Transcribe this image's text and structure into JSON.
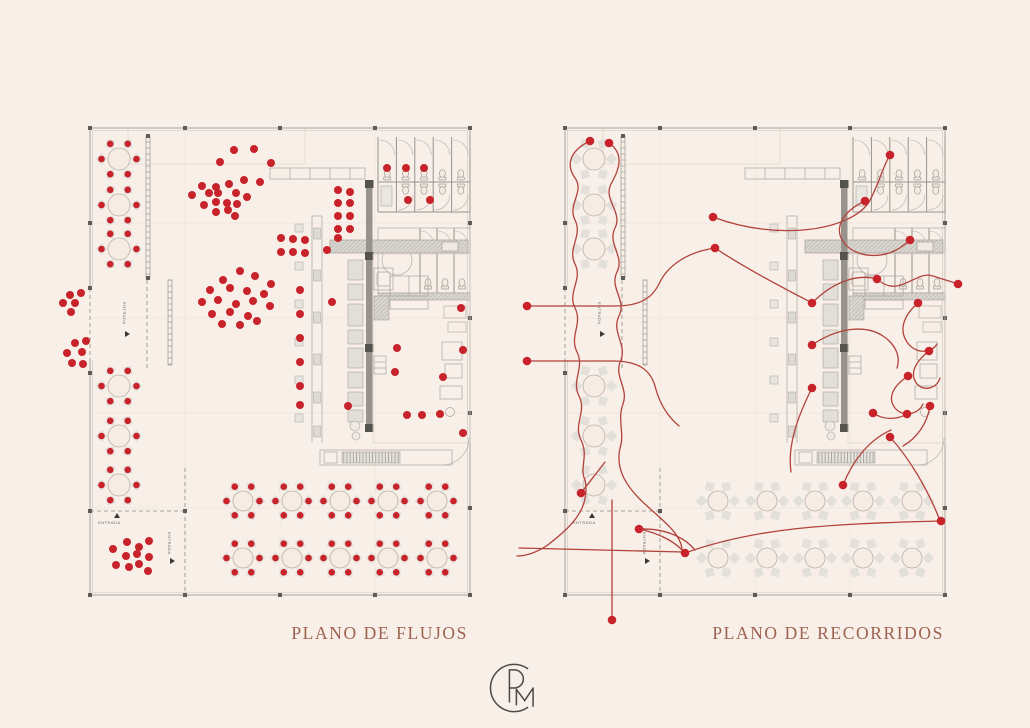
{
  "titles": {
    "left": "PLANO DE FLUJOS",
    "right": "PLANO DE RECORRIDOS"
  },
  "labels": {
    "entrance": "ENTRADA"
  },
  "logo": {
    "monogram": "CRM"
  },
  "colors": {
    "background": "#f8efe8",
    "dot": "#c8232a",
    "route": "#b2423c",
    "title": "#9e6250",
    "line": "#b7b1aa",
    "wall": "#97938c",
    "column": "#5f5c57",
    "furniture": "#e3e0db"
  },
  "furniture": {
    "small_tables": [
      [
        29,
        31
      ],
      [
        29,
        77
      ],
      [
        29,
        121
      ],
      [
        29,
        258
      ],
      [
        29,
        308
      ],
      [
        29,
        357
      ]
    ],
    "big_table_xs": [
      153,
      202,
      250,
      298,
      347
    ],
    "big_table_ys": [
      373,
      430
    ]
  },
  "plans": [
    {
      "id": "flujos",
      "title": "PLANO DE FLUJOS",
      "dots": [
        [
          144,
          22
        ],
        [
          164,
          21
        ],
        [
          130,
          34
        ],
        [
          181,
          35
        ],
        [
          112,
          58
        ],
        [
          126,
          59
        ],
        [
          139,
          56
        ],
        [
          154,
          52
        ],
        [
          170,
          54
        ],
        [
          102,
          67
        ],
        [
          119,
          65
        ],
        [
          128,
          65
        ],
        [
          146,
          65
        ],
        [
          157,
          69
        ],
        [
          114,
          77
        ],
        [
          126,
          74
        ],
        [
          137,
          75
        ],
        [
          147,
          76
        ],
        [
          126,
          84
        ],
        [
          138,
          82
        ],
        [
          145,
          88
        ],
        [
          150,
          143
        ],
        [
          165,
          148
        ],
        [
          133,
          152
        ],
        [
          181,
          156
        ],
        [
          120,
          162
        ],
        [
          140,
          160
        ],
        [
          157,
          163
        ],
        [
          174,
          166
        ],
        [
          112,
          174
        ],
        [
          128,
          172
        ],
        [
          146,
          176
        ],
        [
          163,
          173
        ],
        [
          180,
          178
        ],
        [
          122,
          186
        ],
        [
          140,
          184
        ],
        [
          158,
          188
        ],
        [
          132,
          196
        ],
        [
          150,
          197
        ],
        [
          167,
          193
        ],
        [
          -20,
          167
        ],
        [
          -9,
          165
        ],
        [
          -27,
          175
        ],
        [
          -15,
          175
        ],
        [
          -19,
          184
        ],
        [
          -4,
          213
        ],
        [
          -15,
          215
        ],
        [
          -8,
          224
        ],
        [
          -23,
          225
        ],
        [
          -18,
          235
        ],
        [
          -7,
          236
        ],
        [
          248,
          62
        ],
        [
          260,
          64
        ],
        [
          248,
          75
        ],
        [
          260,
          75
        ],
        [
          248,
          88
        ],
        [
          260,
          88
        ],
        [
          248,
          101
        ],
        [
          260,
          101
        ],
        [
          248,
          110
        ],
        [
          237,
          122
        ],
        [
          191,
          110
        ],
        [
          203,
          111
        ],
        [
          215,
          112
        ],
        [
          191,
          124
        ],
        [
          203,
          124
        ],
        [
          215,
          125
        ],
        [
          210,
          162
        ],
        [
          210,
          186
        ],
        [
          210,
          210
        ],
        [
          210,
          234
        ],
        [
          210,
          258
        ],
        [
          210,
          277
        ],
        [
          242,
          174
        ],
        [
          307,
          220
        ],
        [
          305,
          244
        ],
        [
          353,
          249
        ],
        [
          258,
          278
        ],
        [
          317,
          287
        ],
        [
          332,
          287
        ],
        [
          350,
          286
        ],
        [
          371,
          180
        ],
        [
          373,
          222
        ],
        [
          373,
          305
        ],
        [
          297,
          40
        ],
        [
          316,
          40
        ],
        [
          334,
          40
        ],
        [
          318,
          72
        ],
        [
          340,
          72
        ],
        [
          37,
          414
        ],
        [
          49,
          419
        ],
        [
          59,
          413
        ],
        [
          23,
          421
        ],
        [
          36,
          428
        ],
        [
          47,
          426
        ],
        [
          59,
          429
        ],
        [
          26,
          437
        ],
        [
          39,
          439
        ],
        [
          49,
          436
        ],
        [
          58,
          443
        ]
      ]
    },
    {
      "id": "recorridos",
      "title": "PLANO DE RECORRIDOS",
      "routes": [
        {
          "d": "M25,13 C6,22 0,36 10,50 C20,64 2,76 10,92 C18,108 2,120 10,136 C18,152 2,164 10,180 C18,196 4,208 12,224 C20,240 6,252 14,268 C22,284 8,296 16,312 C24,328 14,340 20,352 C26,382 4,400 -16,416 C-28,425 -40,428 -48,428",
          "dots": [
            [
              25,
              13
            ]
          ]
        },
        {
          "d": "M44,15 C60,26 54,42 46,56 C38,72 58,84 50,100 C42,116 60,128 52,144 C44,160 62,172 54,188 C46,204 62,216 56,232 C48,248 64,260 58,276 C52,292 60,306 55,320 C50,342 62,360 82,378 C100,394 118,408 117,424",
          "dots": [
            [
              44,
              15
            ]
          ]
        },
        {
          "d": "M-46,420 L118,424",
          "dots": []
        },
        {
          "d": "M120,425 C190,400 260,396 376,393",
          "dots": [
            [
              120,
              425
            ],
            [
              376,
              393
            ]
          ]
        },
        {
          "d": "M47,372 L47,492",
          "dots": [
            [
              47,
              492
            ]
          ]
        },
        {
          "d": "M74,401 C98,406 112,416 119,424 M74,401 C104,400 122,412 130,422",
          "dots": [
            [
              74,
              401
            ]
          ]
        },
        {
          "d": "M16,365 C26,352 34,342 40,334",
          "dots": [
            [
              16,
              365
            ]
          ]
        },
        {
          "d": "M-38,178 L50,178 C78,178 88,168 94,156 C102,138 122,124 150,120",
          "dots": [
            [
              -38,
              178
            ],
            [
              150,
              120
            ]
          ]
        },
        {
          "d": "M-38,233 L48,233 C76,233 86,244 90,258 C94,274 102,288 114,298",
          "dots": [
            [
              -38,
              233
            ]
          ]
        },
        {
          "d": "M148,89 C214,114 286,102 304,74 C314,56 318,38 325,27",
          "dots": [
            [
              148,
              89
            ],
            [
              325,
              27
            ]
          ]
        },
        {
          "d": "M300,73 C276,84 268,102 280,116 C292,130 322,134 345,112",
          "dots": [
            [
              300,
              73
            ],
            [
              345,
              112
            ]
          ]
        },
        {
          "d": "M247,175 C270,152 294,146 312,151",
          "dots": [
            [
              247,
              175
            ],
            [
              312,
              151
            ]
          ]
        },
        {
          "d": "M316,154 C336,168 352,142 368,148 C380,152 388,154 393,156",
          "dots": [
            [
              393,
              156
            ]
          ]
        },
        {
          "d": "M247,217 C272,200 300,196 318,208 C330,216 336,228 332,240",
          "dots": [
            [
              247,
              217
            ]
          ]
        },
        {
          "d": "M247,260 C234,286 222,316 226,344",
          "dots": [
            [
              247,
              260
            ]
          ]
        },
        {
          "d": "M353,175 C338,188 334,202 342,214 C350,226 366,226 372,216",
          "dots": [
            [
              353,
              175
            ]
          ]
        },
        {
          "d": "M364,223 C350,234 344,246 352,256 C360,264 372,260 375,250",
          "dots": [
            [
              364,
              223
            ]
          ]
        },
        {
          "d": "M343,248 C328,258 322,270 330,280 C338,290 354,286 358,276",
          "dots": [
            [
              343,
              248
            ]
          ]
        },
        {
          "d": "M308,285 C318,292 332,292 342,286",
          "dots": [
            [
              308,
              285
            ],
            [
              342,
              286
            ]
          ]
        },
        {
          "d": "M365,278 C362,296 352,310 338,318",
          "dots": [
            [
              365,
              278
            ]
          ]
        },
        {
          "d": "M278,357 C288,332 304,312 326,302",
          "dots": [
            [
              278,
              357
            ]
          ]
        },
        {
          "d": "M325,309 C344,330 362,360 374,390",
          "dots": [
            [
              325,
              309
            ]
          ]
        },
        {
          "d": "M150,120 C180,140 215,158 247,175",
          "dots": []
        }
      ]
    }
  ]
}
